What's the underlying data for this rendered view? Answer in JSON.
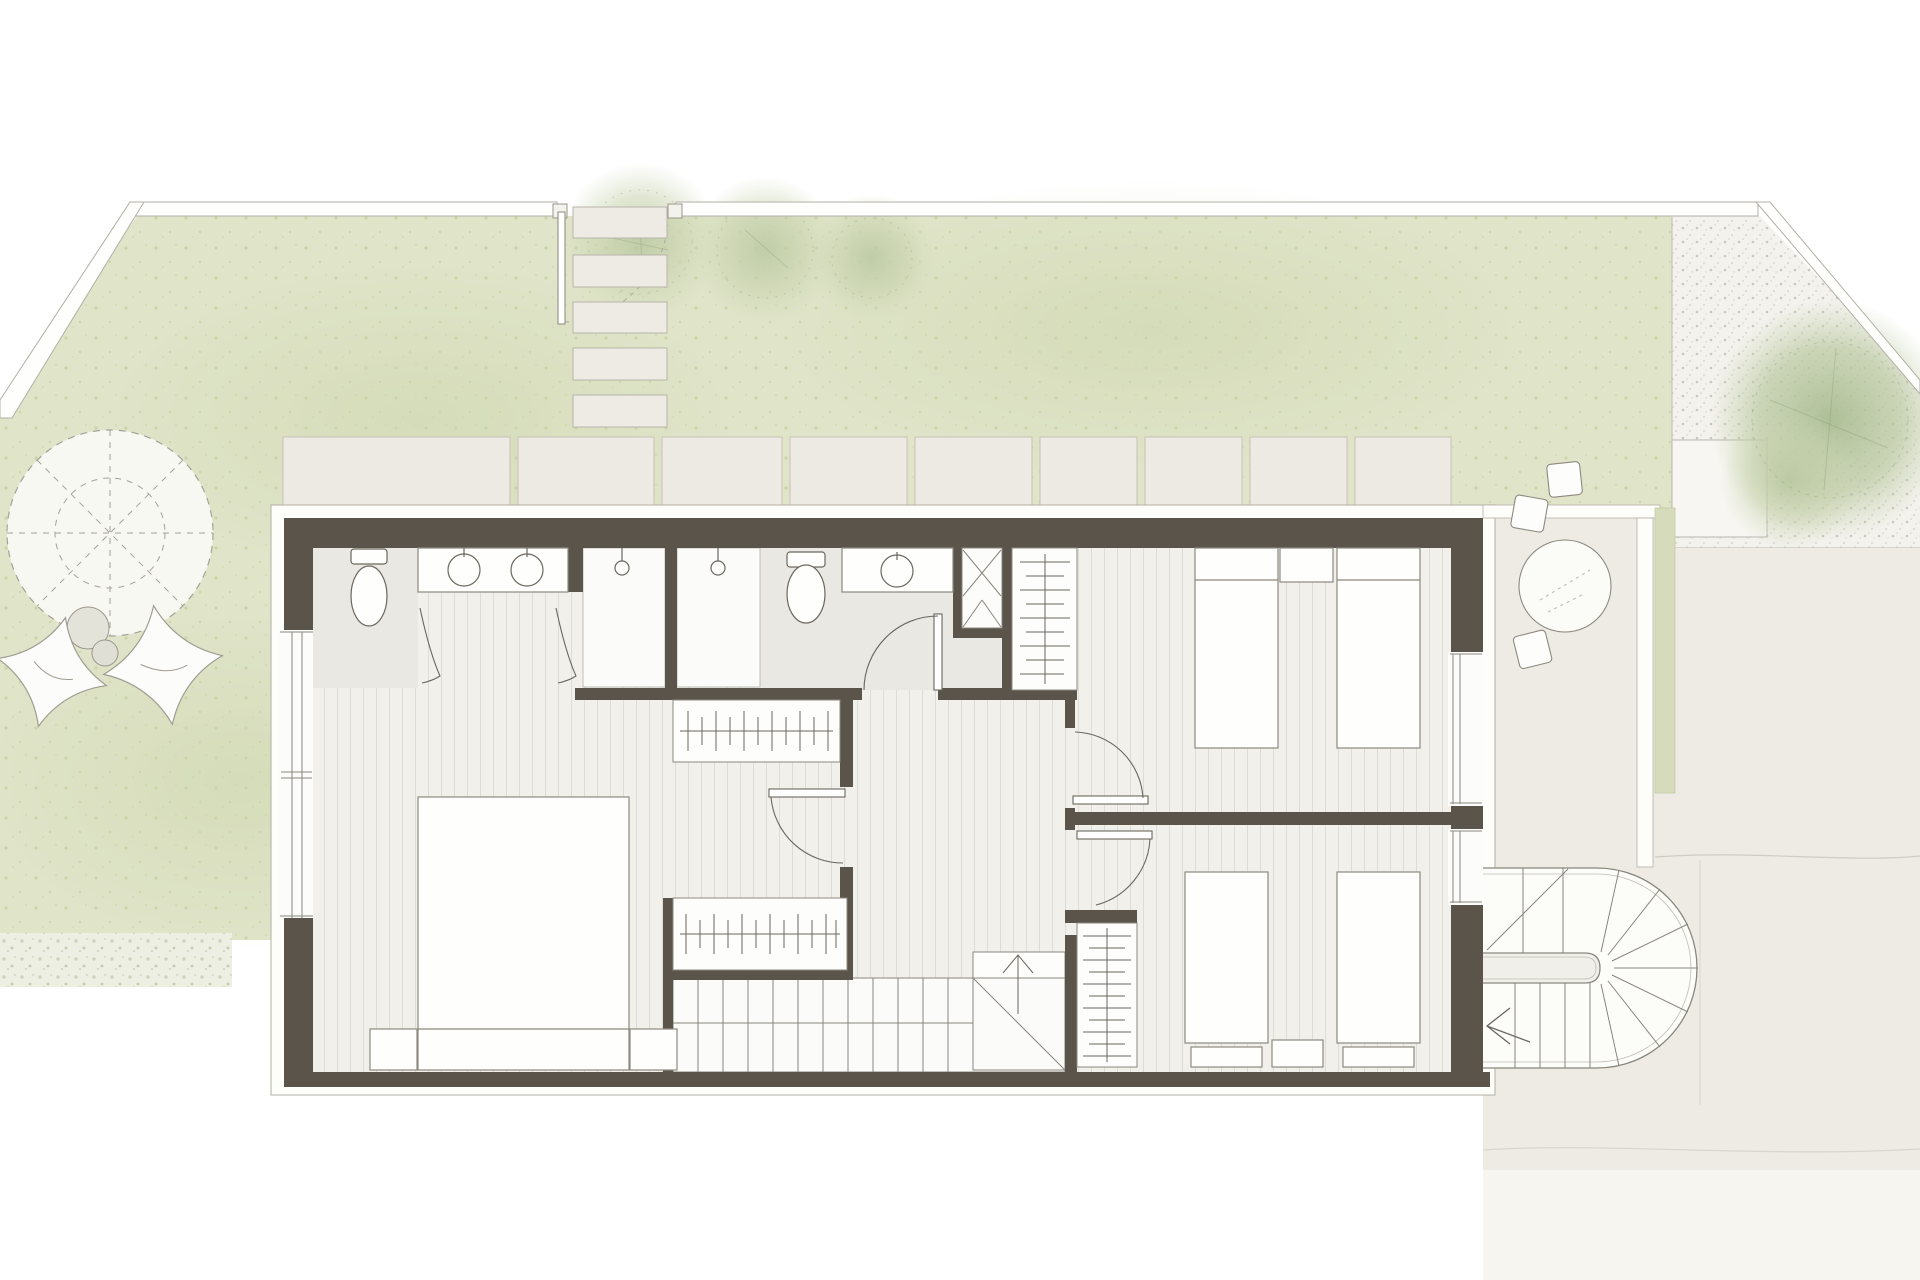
{
  "document": {
    "type": "architectural-floor-plan",
    "view": "top-down site plan, upper floor",
    "visible_text": "none"
  },
  "palette": {
    "page": "#ffffff",
    "grass": "#e0e4c9",
    "grass_dot": "#c4cf9f",
    "gravel": "#f3f2ed",
    "paving": "#edebe4",
    "paver_slab": "#edeae3",
    "slab_edge": "#fdfdfa",
    "wall": "#5b544a",
    "line": "#6b675e",
    "thin_line": "#8d897f",
    "border_light": "#b3afa6",
    "floor_plank": "#f1f0eb",
    "plank_line": "#dddcd6",
    "bath_floor": "#e9e8e3",
    "shower_floor": "#fbfbf9",
    "green_strip": "#d6dcbb",
    "tree_green": "#b9c8a0",
    "white_furniture": "#fefefc"
  },
  "garden": {
    "fence": {
      "segments": 2,
      "diagonal_segments": 2,
      "gate": {
        "posts": 2,
        "leaf": 1,
        "swing_arc": "dashed"
      }
    },
    "stepping_stones": {
      "count": 5
    },
    "paver_strip": {
      "count": 9
    },
    "lawn_trees": {
      "count": 3
    },
    "gravel_tree": {
      "count": 1
    },
    "pergola_circle": {
      "spokes": 8,
      "inner_circle": "dashed",
      "outer_radius_px": 103
    },
    "shrubs": {
      "count": 2
    },
    "beanbags": {
      "count": 2
    },
    "gravel_bed": {
      "paver_inset": 1
    },
    "flower_bed": {
      "count": 1
    }
  },
  "house": {
    "floor": "upper",
    "rooms": [
      {
        "name": "master-bedroom",
        "furniture": [
          "double-bed",
          "nightstand",
          "nightstand"
        ]
      },
      {
        "name": "dressing-area",
        "furniture": [
          "wardrobe-rail-1",
          "wardrobe-rail-2"
        ],
        "hangers_per_rail": 11
      },
      {
        "name": "bathroom-1",
        "fixtures": [
          "toilet",
          "double-vanity",
          "basin",
          "basin"
        ]
      },
      {
        "name": "shower-1",
        "fixtures": [
          "shower-head"
        ]
      },
      {
        "name": "shower-2",
        "fixtures": [
          "shower-head"
        ]
      },
      {
        "name": "bathroom-2",
        "fixtures": [
          "toilet",
          "vanity",
          "basin"
        ]
      },
      {
        "name": "duct-shaft",
        "symbol": "cross-brace"
      },
      {
        "name": "hallway",
        "doors": 4
      },
      {
        "name": "main-staircase",
        "treads": 11,
        "landing": "quarter with diagonal",
        "direction_arrow": "up"
      },
      {
        "name": "bedroom-top-right",
        "furniture": [
          "single-bed",
          "single-bed",
          "nightstand",
          "wardrobe-rail"
        ]
      },
      {
        "name": "bedroom-bottom-right",
        "furniture": [
          "single-bed",
          "single-bed",
          "nightstand",
          "pillow",
          "pillow",
          "wardrobe-rail"
        ]
      }
    ],
    "windows": {
      "west_band": 1,
      "east_bands": 2
    },
    "beds_total": 5,
    "toilets_total": 2,
    "basins_total": 3
  },
  "terrace": {
    "round_table": 1,
    "chairs": 3,
    "green_planting_strip": 1,
    "spiral_staircase": {
      "shape": "D",
      "radial_treads": 7,
      "straight_treads": 6,
      "newel": "stadium pill",
      "arrow": "left chevron"
    }
  }
}
